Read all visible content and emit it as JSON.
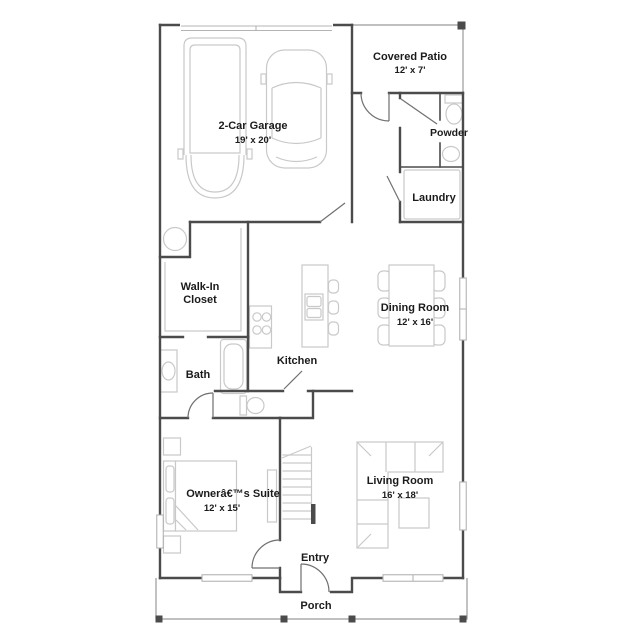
{
  "rooms": {
    "garage": {
      "name": "2-Car Garage",
      "dims": "19' x 20'"
    },
    "covered_patio": {
      "name": "Covered Patio",
      "dims": "12' x 7'"
    },
    "powder": {
      "name": "Powder"
    },
    "laundry": {
      "name": "Laundry"
    },
    "walk_in_closet": {
      "name_line1": "Walk-In",
      "name_line2": "Closet"
    },
    "kitchen": {
      "name": "Kitchen"
    },
    "dining_room": {
      "name": "Dining Room",
      "dims": "12' x 16'"
    },
    "bath": {
      "name": "Bath"
    },
    "owners_suite": {
      "name": "Ownerâ€™s Suite",
      "dims": "12' x 15'"
    },
    "living_room": {
      "name": "Living Room",
      "dims": "16' x 18'"
    },
    "entry": {
      "name": "Entry"
    },
    "porch": {
      "name": "Porch"
    }
  },
  "colors": {
    "wall": "#4b4b4b",
    "fixture": "#c9c9c9",
    "text": "#1b1b1b",
    "bg": "#ffffff"
  }
}
